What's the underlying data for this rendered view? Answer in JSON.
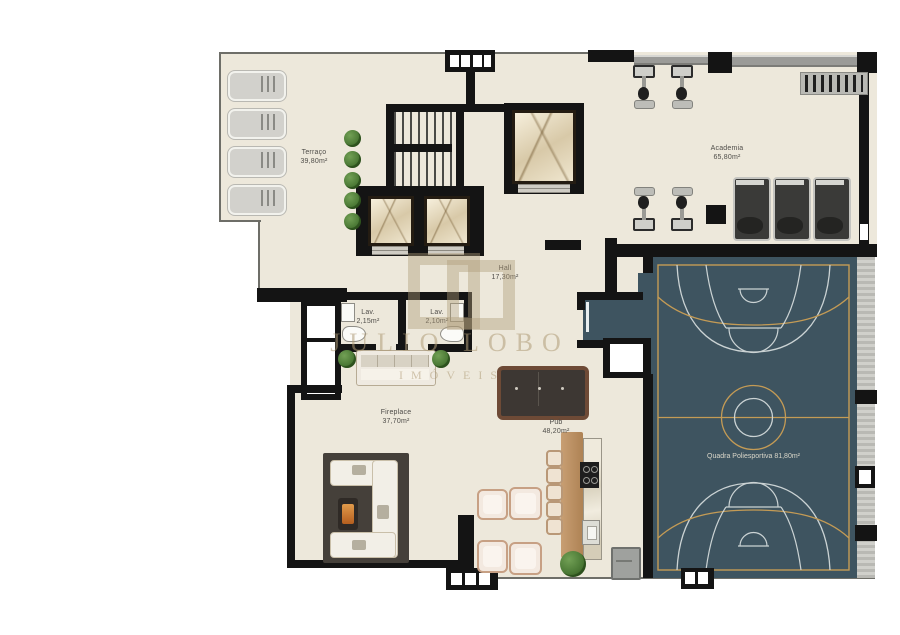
{
  "plan_title": "amenities-floor-plan",
  "rooms": {
    "terraco": {
      "name": "Terraço",
      "area": "39,80m²"
    },
    "academia": {
      "name": "Academia",
      "area": "65,80m²"
    },
    "hall": {
      "name": "Hall",
      "area": "17,30m²"
    },
    "lav1": {
      "name": "Lav.",
      "area": "2,15m²"
    },
    "lav2": {
      "name": "Lav.",
      "area": "2,10m²"
    },
    "fireplace": {
      "name": "Fireplace",
      "area": "37,70m²"
    },
    "pub": {
      "name": "Pub",
      "area": "48,20m²"
    },
    "quadra": {
      "label": "Quadra Poliesportiva 81,80m²"
    }
  },
  "watermark": {
    "line1": "JULIO LOBO",
    "line2": "IMÓVEIS"
  },
  "colors": {
    "floor": "#EDE8DB",
    "wall": "#141414",
    "court": "#3E5460",
    "court_accent_line": "#C49B55",
    "court_white_line": "#CBD3D4",
    "greenery": "#4c7a36",
    "wood": "#C89F73",
    "watermark_tan": "#AE9B76"
  }
}
